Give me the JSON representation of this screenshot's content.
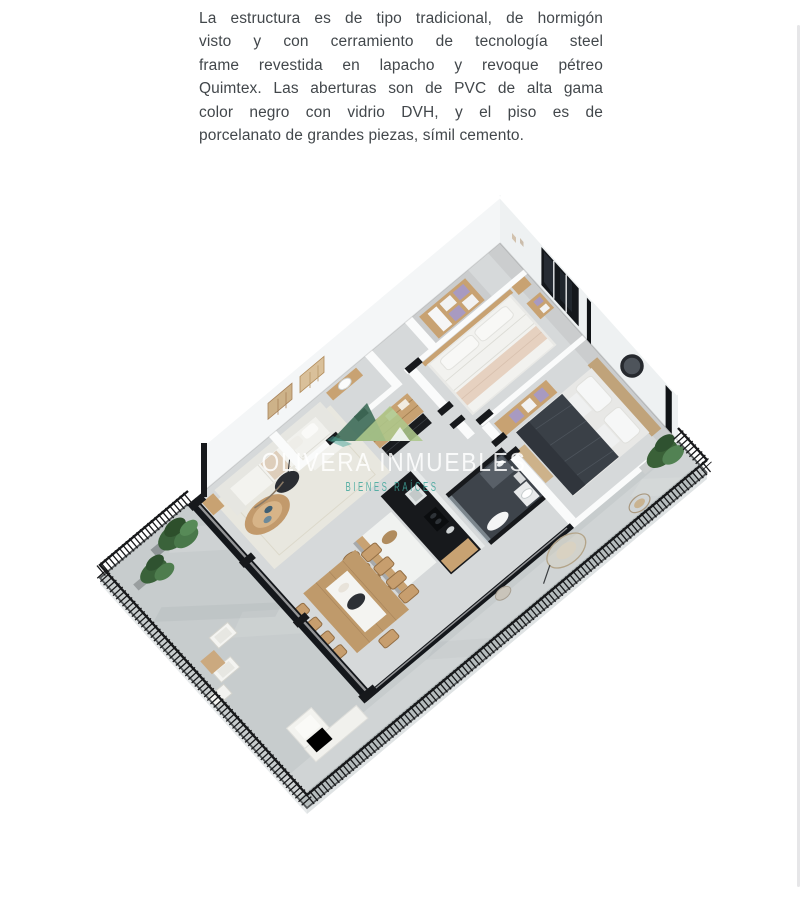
{
  "page": {
    "background": "#ffffff"
  },
  "description": {
    "lines": [
      "La estructura es de tipo tradicional, de hormigón",
      "visto y con cerramiento de tecnología steel",
      "frame revestida en lapacho y revoque pétreo",
      "Quimtex. Las aberturas son de PVC de alta gama",
      "color negro con vidrio DVH, y el piso es de",
      "porcelanato de grandes piezas, símil cemento."
    ]
  },
  "floorplan": {
    "watermark": {
      "brand": "OLIVERA INMUEBLES",
      "tagline": "BIENES RAÍCES"
    }
  },
  "colors": {
    "page_bg": "#ffffff",
    "text": "#42474b",
    "concrete": "#c7cccd",
    "interior_floor": "#d6d9da",
    "wall_face": "#eef1f2",
    "wall_face_left": "#f4f6f7",
    "wall_top": "#ffffff",
    "accent_black": "#17191c",
    "glass_dark": "#14171b",
    "wood": "#c8a272",
    "wood_deep": "#b08a58",
    "dark_bed": "#3a4047",
    "lilac": "#a89ac1",
    "sofa": "#f3f3ef",
    "rug": "#eae8df",
    "plant": "#3a623a",
    "railing": "#17181a",
    "slab_edge": "#e7eaeb",
    "brand_white": "rgba(255,255,255,0.85)",
    "tagline_teal": "#41a79c",
    "logo_dark": "#3f6d59",
    "logo_light": "#adc78b",
    "scrollbar": "#e6e6e8"
  }
}
